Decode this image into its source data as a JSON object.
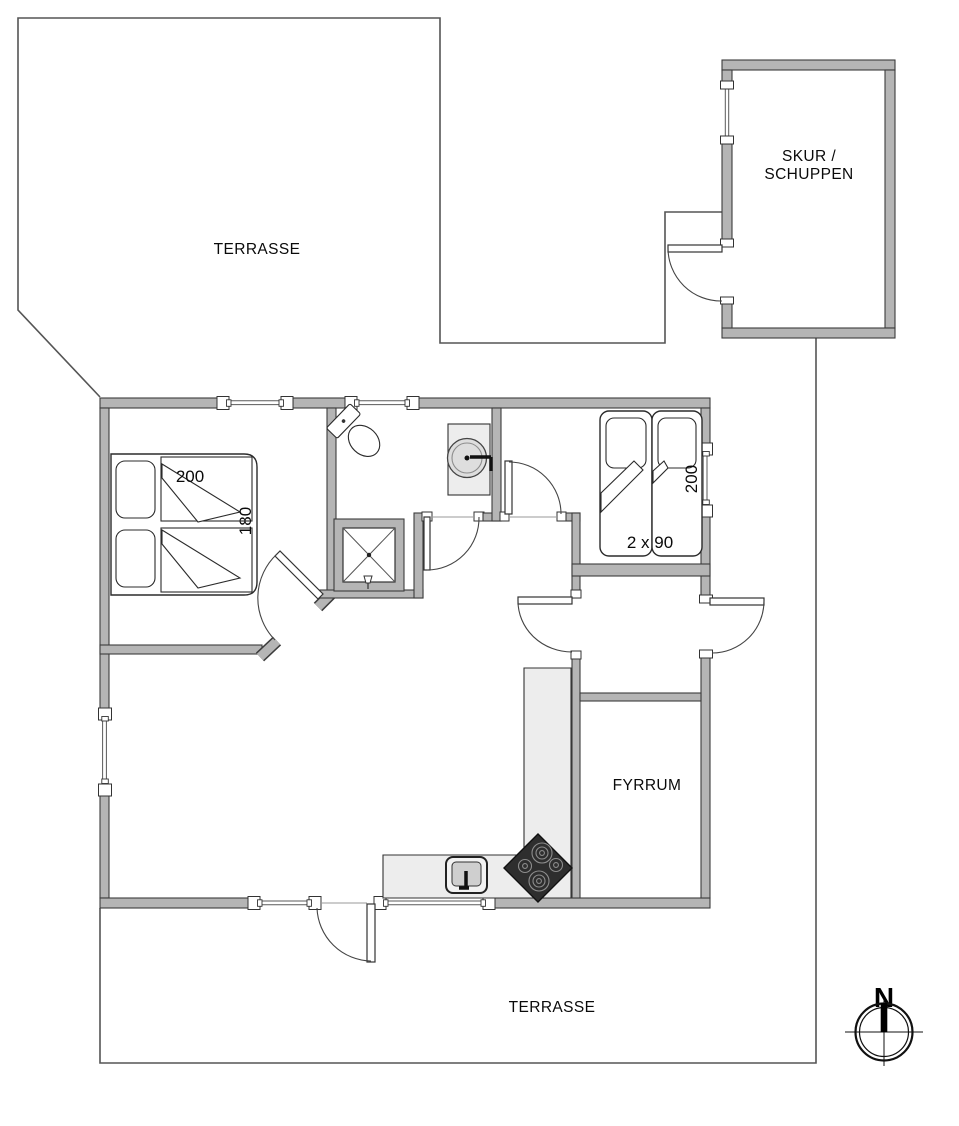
{
  "plan": {
    "rooms": {
      "terrace_top_label": "TERRASSE",
      "terrace_bottom_label": "TERRASSE",
      "shed_label_line1": "SKUR /",
      "shed_label_line2": "SCHUPPEN",
      "boiler_room_label": "FYRRUM"
    },
    "dimensions": {
      "double_bed_width_cm": "200",
      "double_bed_length_cm": "180",
      "single_beds_label": "2 x 90",
      "single_bed_length_cm": "200"
    },
    "compass": {
      "north_label": "N"
    },
    "colors": {
      "wall_fill": "#b5b5b5",
      "wall_stroke": "#3c3c3c",
      "counter_fill": "#ededed",
      "appliance_dark": "#2e2e2e",
      "line_color": "#555555",
      "background": "#ffffff"
    }
  }
}
